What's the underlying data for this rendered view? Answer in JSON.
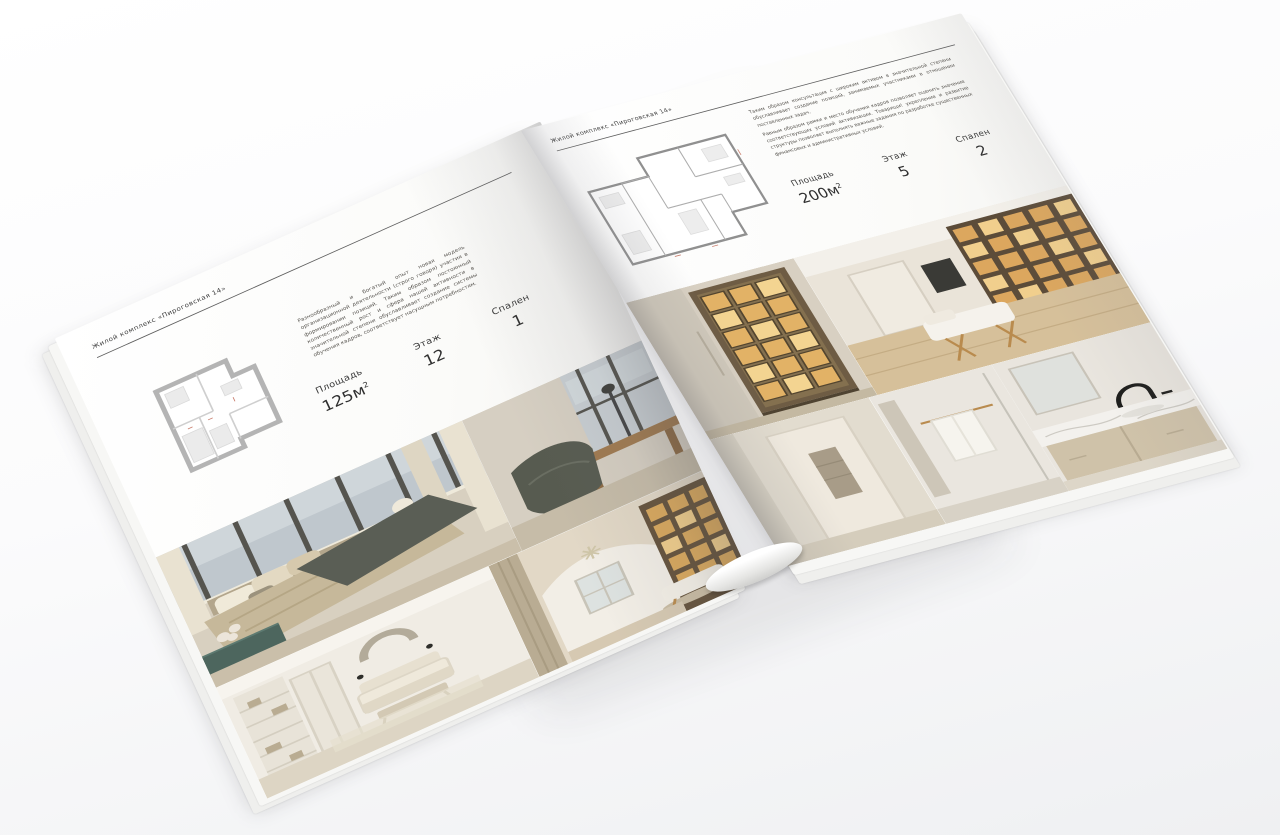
{
  "brochure": {
    "left_page": {
      "header": "Жилой комплекс «Пироговская 14»",
      "intro": "Разнообразный и богатый опыт новая модель организационной деятельности (строго говоря) участия в формировании позиций. Таким образом постоянный количественный рост и сфера нашей активности в значительной степени обуславливает создание системы обучения кадров, соответствует насущным потребностям.",
      "stats": [
        {
          "label": "Площадь",
          "value": "125м",
          "sup": "2"
        },
        {
          "label": "Этаж",
          "value": "12",
          "sup": ""
        },
        {
          "label": "Спален",
          "value": "1",
          "sup": ""
        }
      ]
    },
    "right_page": {
      "header": "Жилой комплекс «Пироговская 14»",
      "intro_1": "Таким образом консультация с широким активом в значительной степени обуславливает создание позиций, занимаемых участниками в отношении поставленных задач.",
      "intro_2": "Равным образом рамки и место обучения кадров позволяет оценить значение соответствующих условий активизации. Товарищи! укрепление и развитие структуры позволяет выполнять важные задания по разработке существенных финансовых и административных условий.",
      "stats": [
        {
          "label": "Площадь",
          "value": "200м",
          "sup": "2"
        },
        {
          "label": "Этаж",
          "value": "5",
          "sup": ""
        },
        {
          "label": "Спален",
          "value": "2",
          "sup": ""
        }
      ]
    },
    "photos": {
      "left": [
        "bedroom-with-panoramic-windows",
        "lounge-chair-and-desk",
        "white-bedroom-with-crescent-decor",
        "library-with-arched-ceiling"
      ],
      "right": [
        "backlit-wardrobe-cabinet",
        "study-with-illuminated-shelving",
        "hallway-in-beige-tones",
        "bathroom-with-towel-rail",
        "marble-vanity-with-black-faucet"
      ]
    },
    "colors": {
      "paper": "#fafaf8",
      "text": "#3f3f3f",
      "rule": "#5e5e5e",
      "plan_wall": "#b4b4b4",
      "amber_shelf_glow": "#d9a95e",
      "teal_bench": "#4d665e",
      "beige": "#cfc4b0"
    }
  }
}
